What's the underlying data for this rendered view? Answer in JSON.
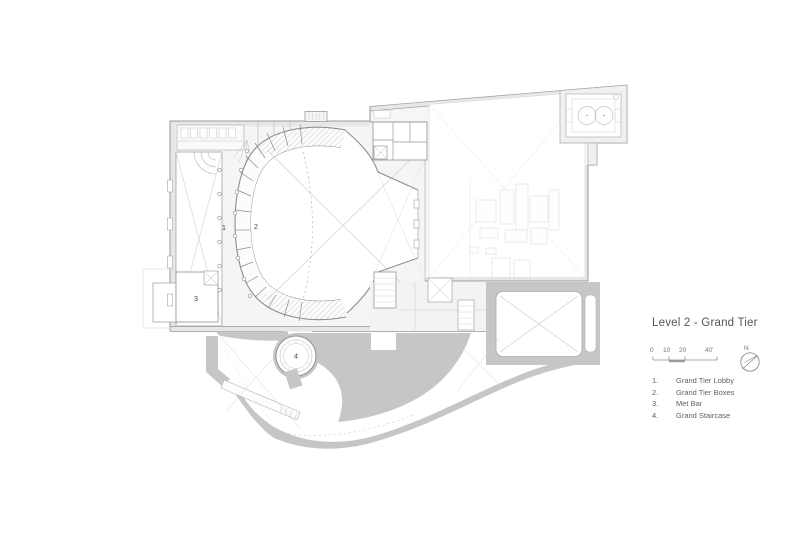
{
  "panel": {
    "title": "Level 2 - Grand Tier",
    "scale": {
      "labels": [
        "0",
        "10",
        "20",
        "40'"
      ]
    },
    "north_label": "N",
    "legend": [
      {
        "num": "1.",
        "label": "Grand Tier Lobby"
      },
      {
        "num": "2.",
        "label": "Grand Tier Boxes"
      },
      {
        "num": "3.",
        "label": "Met Bar"
      },
      {
        "num": "4.",
        "label": "Grand Staircase"
      }
    ]
  },
  "plan": {
    "room_numbers": [
      {
        "n": "1"
      },
      {
        "n": "2"
      },
      {
        "n": "3"
      },
      {
        "n": "4"
      }
    ],
    "colors": {
      "wall_line": "#9b9898",
      "poche": "#e8e6e6",
      "gray_fill": "#c8c5c7",
      "light_fill": "#f6f5f5",
      "text": "#56565a"
    }
  }
}
